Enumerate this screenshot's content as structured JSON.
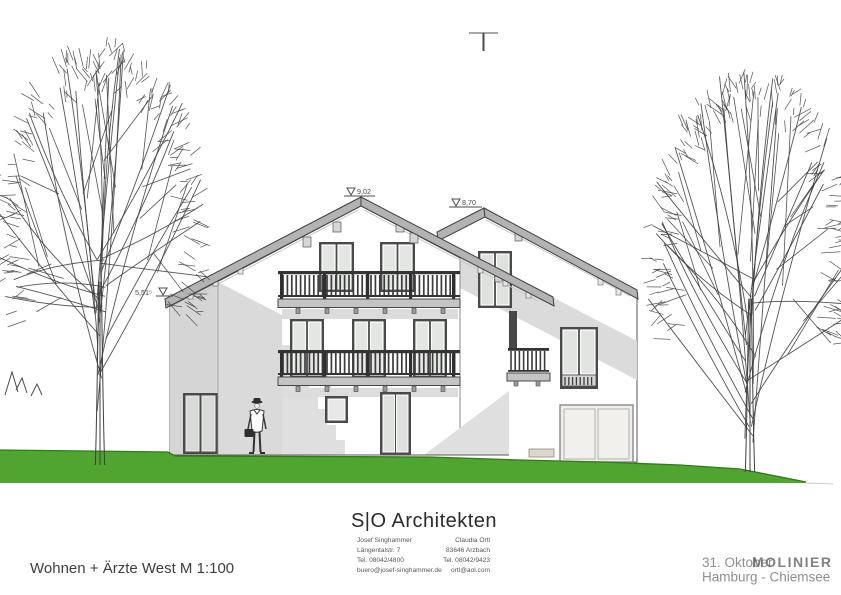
{
  "drawing": {
    "level_markers": {
      "main_ridge": "9,02",
      "right_ridge": "8,70",
      "left_eave": "5,51⁵"
    }
  },
  "title_block": {
    "logo": "S|O Architekten",
    "partner_left": {
      "name": "Josef Singhammer",
      "street": "Längentalstr. 7",
      "phone": "Tel. 08042/4800",
      "email": "buero@josef-singhammer.de"
    },
    "partner_right": {
      "name": "Claudia Ortl",
      "city": "83646 Arzbach",
      "phone": "Tel. 08042/9423",
      "email": "ortl@aol.com"
    },
    "drawing_title": "Wohnen + Ärzte West M 1:100",
    "date": "31. Oktober",
    "location": "Hamburg - Chiemsee",
    "watermark": "MOLINIER"
  },
  "colors": {
    "grass": "#4FA52F",
    "grass_edge": "#2E7D15",
    "roof_fascia": "#b3b3b3",
    "window_frame": "#4a4a4a",
    "wall_shadow": "#dadada"
  }
}
